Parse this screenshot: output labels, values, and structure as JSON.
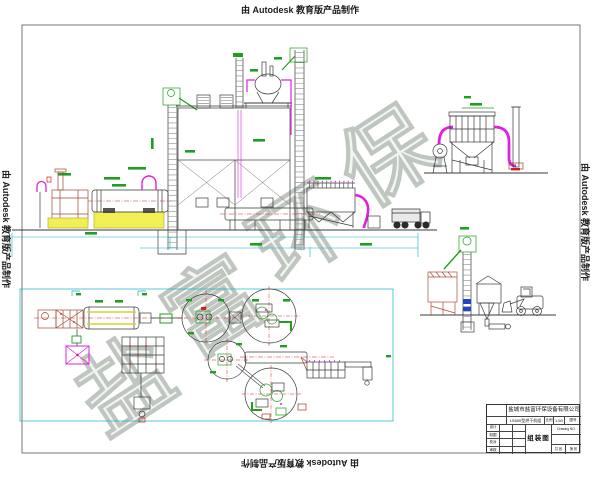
{
  "stamps": {
    "top": "由 Autodesk 教育版产品制作",
    "bottom": "由 Autodesk 教育版产品制作",
    "left": "由 Autodesk 教育版产品制作",
    "right": "由 Autodesk 教育版产品制作"
  },
  "watermark": {
    "char1": "盐",
    "char2": "富",
    "char3": "环",
    "char4": "保",
    "color": "#bfc6bf"
  },
  "title_block": {
    "company": "盐城市盐富环保设备有限公司",
    "drawing_code": "LS600型烘干机组",
    "scale_label": "比例",
    "scale_value": "1:50",
    "drawing_no_label": "图号",
    "drawing_no_en": "Drawing NO.",
    "title": "组装图",
    "rows": [
      {
        "label": "设计"
      },
      {
        "label": "制图"
      },
      {
        "label": "校对"
      },
      {
        "label": "审核"
      }
    ],
    "sheet_total": "共 张",
    "sheet_no": "第 张"
  },
  "colors": {
    "line": "#3a3a3a",
    "magenta": "#e020e0",
    "green": "#1f9e1f",
    "yellow": "#f2ef55",
    "cad_red": "#cc2222",
    "furnace_brown": "#9c4a35",
    "cyan": "#17b3c1",
    "blue": "#2244cc"
  }
}
